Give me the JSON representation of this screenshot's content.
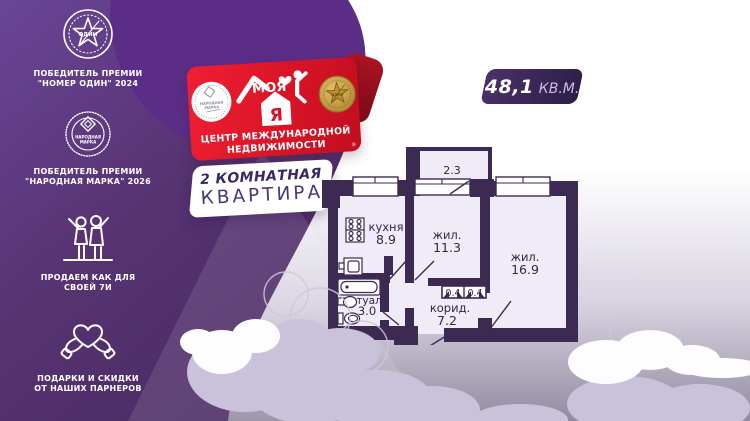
{
  "sidebar": {
    "items": [
      {
        "badge_text": "ОДИН",
        "caption1": "ПОБЕДИТЕЛЬ ПРЕМИИ",
        "caption2": "\"НОМЕР ОДИН\" 2024"
      },
      {
        "badge_line1": "НАРОДНАЯ",
        "badge_line2": "МАРКА",
        "caption1": "ПОБЕДИТЕЛЬ ПРЕМИИ",
        "caption2": "\"НАРОДНАЯ МАРКА\" 2026"
      },
      {
        "caption1": "ПРОДАЕМ КАК ДЛЯ",
        "caption2": "СВОЕЙ 7И"
      },
      {
        "caption1": "ПОДАРКИ И СКИДКИ",
        "caption2": "ОТ НАШИХ ПАРНЕРОВ"
      }
    ]
  },
  "brand": {
    "name": "МОЯ",
    "ya": "Я",
    "reg": "®",
    "tagline1": "ЦЕНТР МЕЖДУНАРОДНОЙ",
    "tagline2": "НЕДВИЖИМОСТИ",
    "left_medal_line1": "НАРОДНАЯ",
    "left_medal_line2": "МАРКА",
    "right_medal_text": "ОДИН"
  },
  "offer": {
    "line1": "2 КОМНАТНАЯ",
    "line2": "КВАРТИРА"
  },
  "area_badge": {
    "value": "48,1",
    "unit": "КВ.М."
  },
  "floorplan": {
    "balcony_area": "2.3",
    "kitchen_name": "кухня",
    "kitchen_area": "8.9",
    "room1_name": "жил.",
    "room1_area": "11.3",
    "room2_name": "жил.",
    "room2_area": "16.9",
    "corridor_name": "корид.",
    "corridor_area": "7.2",
    "bath_name": "туал",
    "bath_area": "3.0",
    "closet1_area": "0.4",
    "closet2_area": "0.4"
  },
  "colors": {
    "panel_purple": "#57326F",
    "blob_purple": "#5C2D87",
    "banner_red": "#DD1628",
    "wall_purple": "#3D2A52",
    "badge_purple": "#3A2759"
  }
}
